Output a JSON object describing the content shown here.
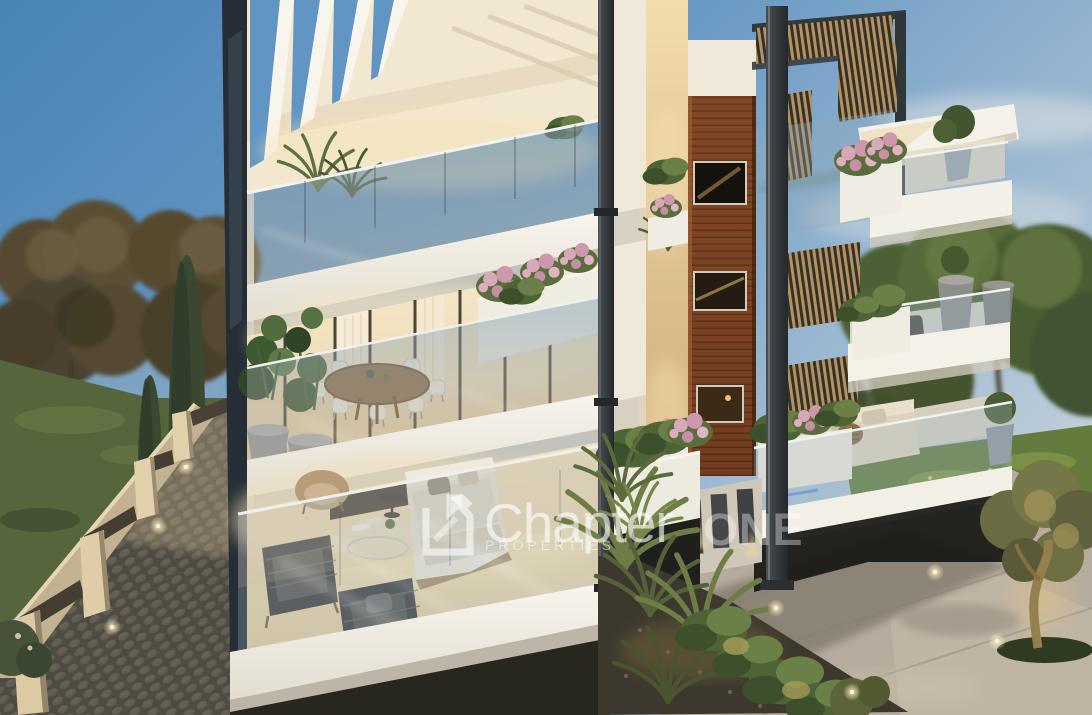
{
  "image": {
    "kind": "3D architectural exterior rendering",
    "subject": "Modern white multi-storey apartment building with planted balconies, glass balustrades and timber-clad core, seen from an elevated corner view at dusk",
    "lighting": "dusk sky with warm interior and landscape lighting"
  },
  "watermark": {
    "logo_icon": "chapter-one-square-logo",
    "brand_primary": "Chapter",
    "brand_secondary": "ONE",
    "subtitle": "PROPERTIES",
    "text_color": "#ffffff",
    "opacity": 0.55
  },
  "palette": {
    "sky_blue": "#4a84b7",
    "sky_horizon": "#c6d2d9",
    "cloud": "#e3e6e4",
    "building_white": "#f4f1e9",
    "slab_shadow": "#cdc7ba",
    "interior_warm": "#f0dfbc",
    "glass_reflection": "#9fb6c8",
    "wood_cladding": "#7c4426",
    "metal_dark": "#33383b",
    "foliage_green": "#4e6336",
    "foliage_light": "#6d8146",
    "flower_pink": "#d7a8b8",
    "lawn_green": "#637c3d",
    "paving_grey": "#b5ac9d",
    "cobblestone_grey": "#6e6a60",
    "boundary_wall_stone": "#d9c6a2",
    "ground_light_warm": "#ffedc0"
  }
}
